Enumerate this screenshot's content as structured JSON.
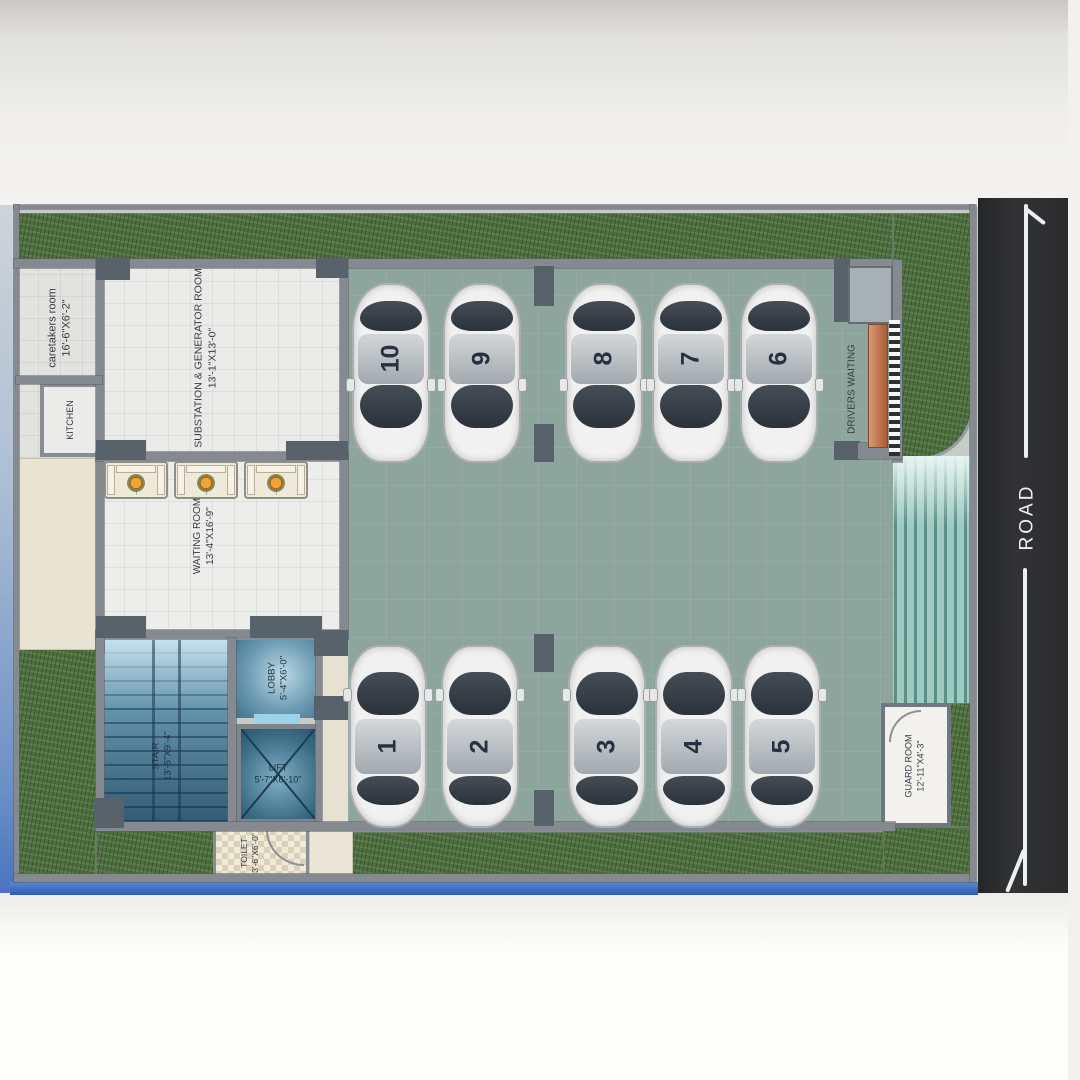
{
  "rooms": [
    {
      "label": "caretakers room",
      "dims": "16'-6\"X6'-2\""
    },
    {
      "label": "KITCHEN",
      "dims": ""
    },
    {
      "label": "SUBSTATION & GENERATOR ROOM",
      "dims": "13'-1\"X13'-0\""
    },
    {
      "label": "WAITING ROOM",
      "dims": "13'-4\"X16'-9\""
    },
    {
      "label": "LOBBY",
      "dims": "5'-4\"X6'-0\""
    },
    {
      "label": "STAIR",
      "dims": "13'-5\"X9'-4\""
    },
    {
      "label": "LIFT",
      "dims": "5'-7\"X6'-10\""
    },
    {
      "label": "TOILET",
      "dims": "3'-6\"X6'-0\""
    },
    {
      "label": "GUARD ROOM",
      "dims": "12'-11\"X4'-3\""
    },
    {
      "label": "DRIVERS WAITING",
      "dims": ""
    }
  ],
  "cars": [
    {
      "number": "10"
    },
    {
      "number": "9"
    },
    {
      "number": "8"
    },
    {
      "number": "7"
    },
    {
      "number": "6"
    },
    {
      "number": "1"
    },
    {
      "number": "2"
    },
    {
      "number": "3"
    },
    {
      "number": "4"
    },
    {
      "number": "5"
    }
  ],
  "road": {
    "label": "ROAD"
  },
  "colors": {
    "grass": "#4e6e41",
    "parking_floor": "#8da59d",
    "road": "#2c2d2f",
    "plan_border_blue": "#3f6fc7",
    "stair_blue": "#4e7f9b",
    "ramp_teal": "#7fb3a9",
    "bench_brown": "#c07a55"
  }
}
